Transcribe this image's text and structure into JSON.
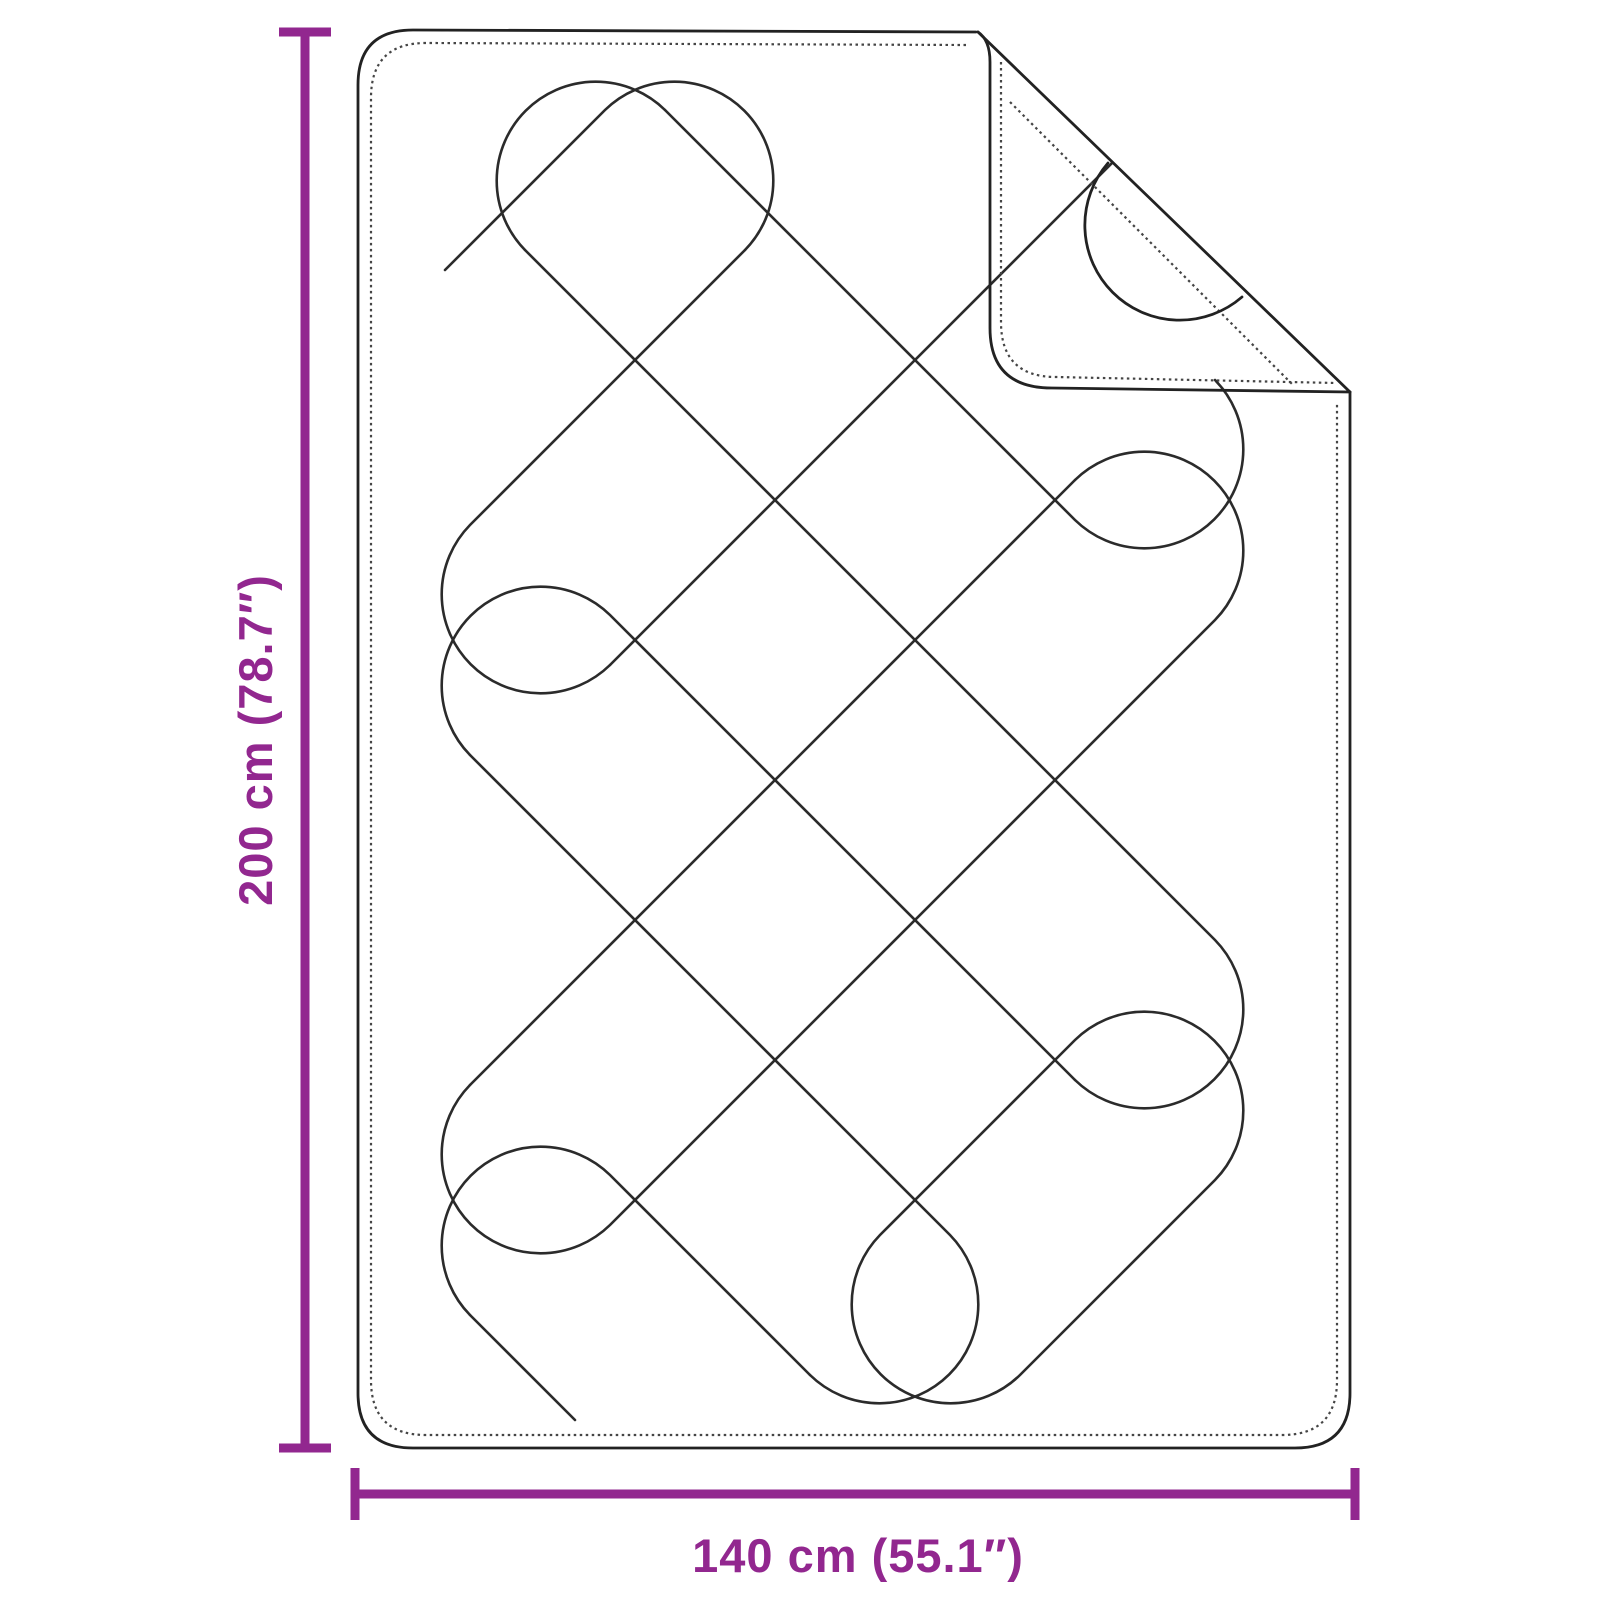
{
  "diagram": {
    "width_label": "140 cm (55.1″)",
    "height_label": "200 cm (78.7″)"
  },
  "colors": {
    "dimension": "#92278F",
    "outline": "#222222",
    "quilt_line": "#2b2b2b",
    "stitch": "#454545",
    "background": "#ffffff"
  }
}
